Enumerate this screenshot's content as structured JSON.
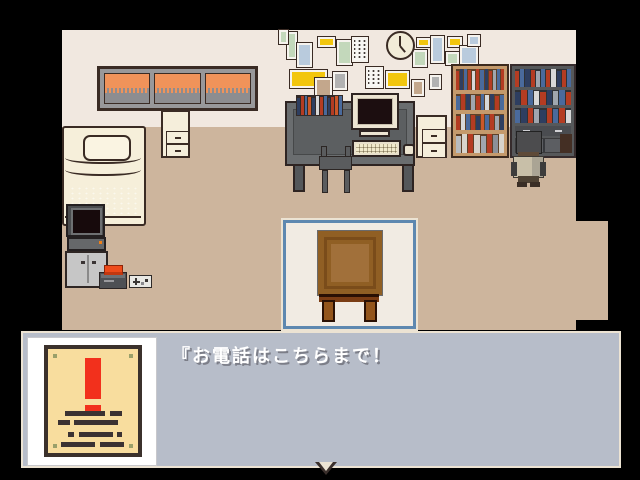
{
  "message_box": {
    "text": "『お電話はこちらまで！",
    "continue_indicator": "down-arrow-icon"
  },
  "selection": {
    "selected_object": "table"
  },
  "poster": {
    "symbol": "exclamation-mark",
    "text_lines": 4
  },
  "palette": {
    "wall": "#f1e8e0",
    "floor": "#cdb59d",
    "outline": "#3a2b24",
    "cream": "#f2ecd8",
    "msgbox_fill": "#b7bdc9",
    "msgbox_border": "#ece3d3",
    "select_blue": "#5e88b0",
    "select_bg": "#f1ebe3",
    "poster_paper": "#f8dd9e",
    "poster_frame": "#3b312c",
    "alert_red": "#f2301c",
    "alert_orange": "#ee4b1a",
    "sky_orange": "#f0935a",
    "hill_gray": "#8d8d90",
    "table_brown": "#905f24",
    "text_white": "#ffffff",
    "text_shadow": "#7c7e88"
  },
  "scene": {
    "clock_time_hands": {
      "minute": "12",
      "hour": "between 4 and 5"
    },
    "wall_frames": [
      {
        "x": 287,
        "y": 32,
        "w": 10,
        "h": 27,
        "color": "#c3d8bb"
      },
      {
        "x": 297,
        "y": 43,
        "w": 15,
        "h": 24,
        "color": "#b9cbdd"
      },
      {
        "x": 318,
        "y": 37,
        "w": 17,
        "h": 10,
        "color": "#f2c60e"
      },
      {
        "x": 337,
        "y": 40,
        "w": 15,
        "h": 25,
        "color": "#c3d8bb"
      },
      {
        "x": 352,
        "y": 37,
        "w": 16,
        "h": 25,
        "type": "notice"
      },
      {
        "x": 290,
        "y": 70,
        "w": 37,
        "h": 18,
        "color": "#f2c60e"
      },
      {
        "x": 315,
        "y": 78,
        "w": 17,
        "h": 20,
        "color": "#c3a78c"
      },
      {
        "x": 333,
        "y": 72,
        "w": 14,
        "h": 18,
        "color": "#b2b2b2"
      },
      {
        "x": 366,
        "y": 67,
        "w": 17,
        "h": 21,
        "type": "notice"
      },
      {
        "x": 386,
        "y": 71,
        "w": 23,
        "h": 17,
        "color": "#f2c60e"
      },
      {
        "x": 417,
        "y": 38,
        "w": 13,
        "h": 9,
        "color": "#f2c60e"
      },
      {
        "x": 413,
        "y": 50,
        "w": 14,
        "h": 17,
        "color": "#c3d8bb"
      },
      {
        "x": 431,
        "y": 36,
        "w": 13,
        "h": 27,
        "color": "#b9cbdd"
      },
      {
        "x": 448,
        "y": 37,
        "w": 14,
        "h": 10,
        "color": "#f2c60e"
      },
      {
        "x": 446,
        "y": 52,
        "w": 13,
        "h": 13,
        "color": "#c3d8bb"
      },
      {
        "x": 460,
        "y": 46,
        "w": 18,
        "h": 19,
        "color": "#b9cbdd"
      },
      {
        "x": 468,
        "y": 35,
        "w": 12,
        "h": 11,
        "color": "#b9cbdd"
      },
      {
        "x": 430,
        "y": 75,
        "w": 11,
        "h": 14,
        "color": "#b2b2b2"
      },
      {
        "x": 412,
        "y": 80,
        "w": 12,
        "h": 16,
        "color": "#c3a78c"
      },
      {
        "x": 279,
        "y": 30,
        "w": 9,
        "h": 14,
        "color": "#c3d8bb"
      }
    ],
    "desk_books": [
      "#2e3e60",
      "#b43c22",
      "#4a6a9c",
      "#cc5828",
      "#2e3e60",
      "#d8d8d8",
      "#b43c22",
      "#4a6a9c",
      "#2e3e60",
      "#b43c22",
      "#cc5828",
      "#4a6a9c"
    ],
    "shelf_light_rows": [
      [
        "#b43c22",
        "#2e3e60",
        "#4a6a9c",
        "#b43c22",
        "#d8d8d8",
        "#b43c22",
        "#4a6a9c",
        "#2e3e60",
        "#b43c22",
        "#a0a6ae",
        "#4a6a9c",
        "#b43c22"
      ],
      [
        "#4a6a9c",
        "#b43c22",
        "#2e3e60",
        "#a0a6ae",
        "#b43c22",
        "#4a6a9c",
        "#d8d8d8",
        "#2e3e60",
        "#b43c22",
        "#4a6a9c"
      ],
      [
        "#b43c22",
        "#d8d8d8",
        "#4a6a9c",
        "#b43c22",
        "#2e3e60",
        "#cc5828",
        "#4a6a9c",
        "#b43c22",
        "#a0a6ae",
        "#2e3e60"
      ],
      [
        "#b8bcc0",
        "#d8d4cc",
        "#b43c22",
        "#d8d4cc",
        "#a0a6ae",
        "#b43c22",
        "#8c9098",
        "#d8d4cc"
      ]
    ],
    "shelf_dark_rows": [
      [
        "#b43c22",
        "#4a6a9c",
        "#2e3e60",
        "#b43c22",
        "#a0a6ae",
        "#4a6a9c",
        "#b43c22",
        "#d8d8d8",
        "#2e3e60",
        "#b43c22",
        "#4a6a9c"
      ],
      [
        "#2e3e60",
        "#b43c22",
        "#4a6a9c",
        "#d8d8d8",
        "#b43c22",
        "#2e3e60",
        "#a0a6ae",
        "#4a6a9c",
        "#b43c22"
      ],
      [
        "#4a6a9c",
        "#2e3e60",
        "#b43c22",
        "#a0a6ae",
        "#2e3e60",
        "#b43c22",
        "#4a6a9c",
        "#b43c22",
        "#d8d8d8"
      ]
    ]
  }
}
